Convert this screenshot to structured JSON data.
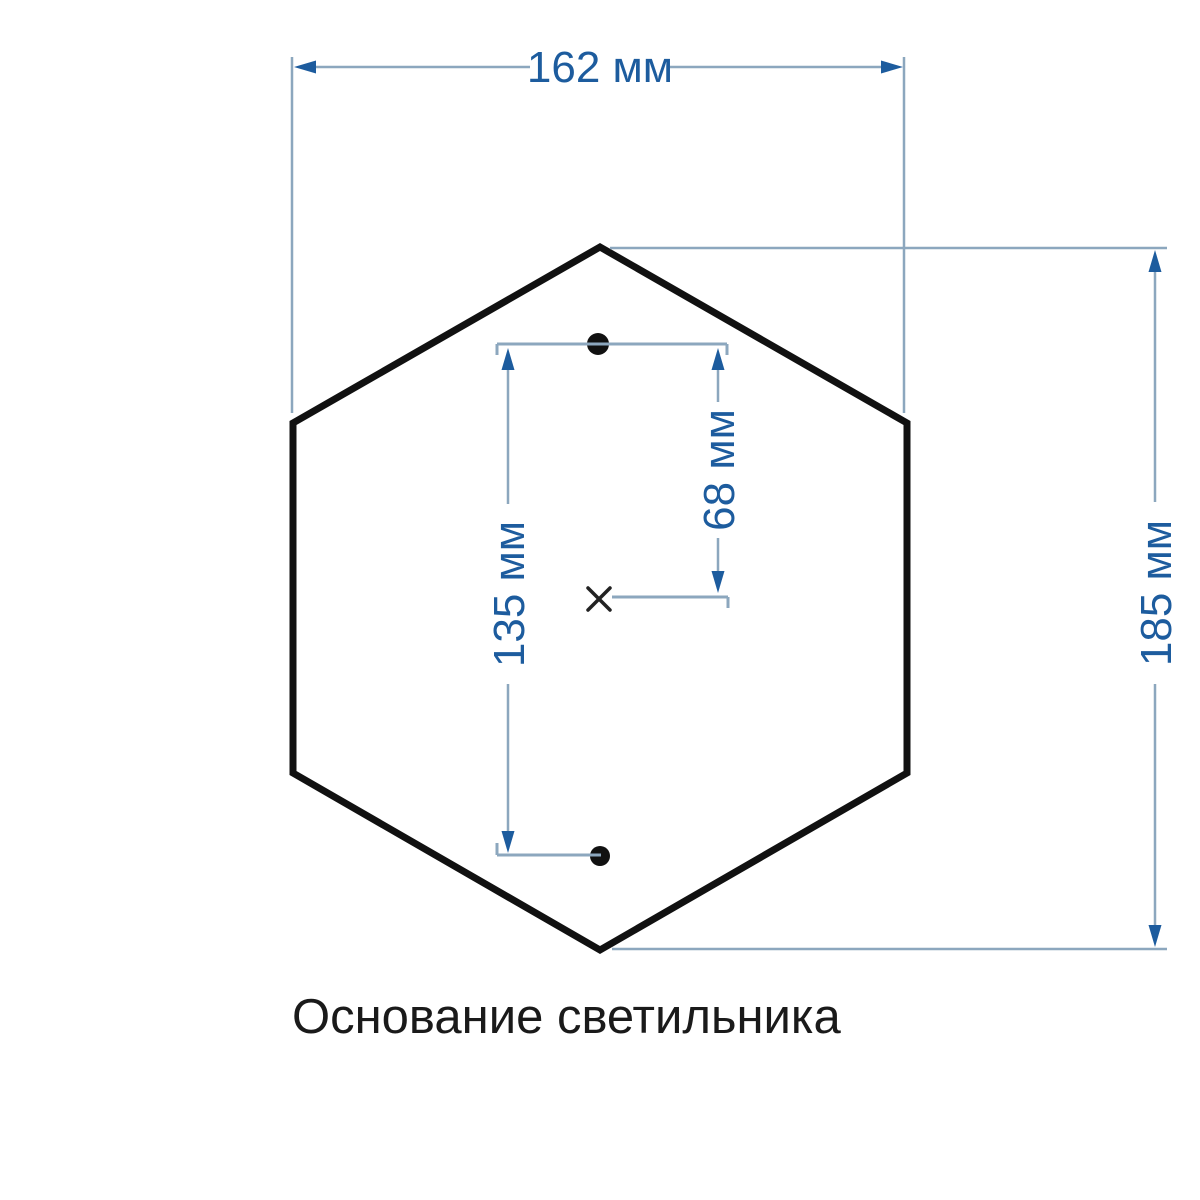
{
  "caption": {
    "text": "Основание светильника"
  },
  "dimensions": {
    "width": {
      "label": "162 мм",
      "value": 162,
      "unit": "мм"
    },
    "height": {
      "label": "185 мм",
      "value": 185,
      "unit": "мм"
    },
    "hole_spacing": {
      "label": "135 мм",
      "value": 135,
      "unit": "мм"
    },
    "hole_offset": {
      "label": "68 мм",
      "value": 68,
      "unit": "мм"
    }
  },
  "shape": {
    "type": "hexagon",
    "mounting_holes": 2,
    "center_mark": "×"
  },
  "colors": {
    "outline": "#111111",
    "dim_line": "#8CA7BE",
    "accent": "#1D5C9E",
    "caption": "#1A1A1A",
    "background": "#FFFFFF"
  }
}
